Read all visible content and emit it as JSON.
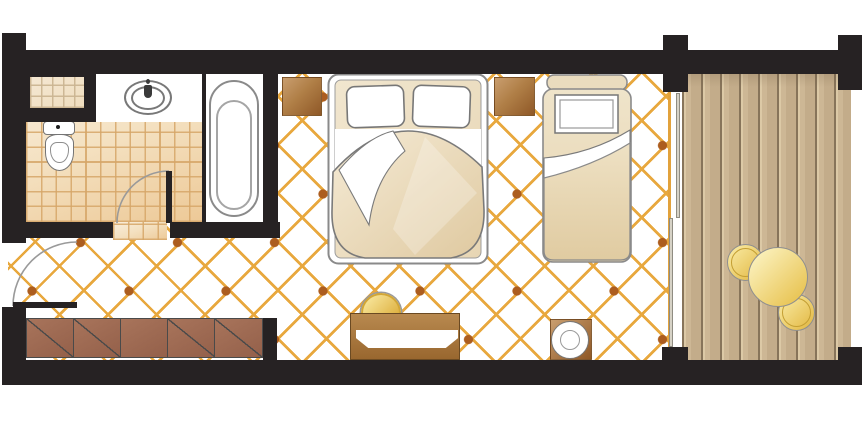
{
  "document": {
    "kind": "hotel-room-floor-plan",
    "visible_text": [],
    "orientation": "landscape"
  },
  "palette": {
    "wall": "#262223",
    "background": "#FFFFFF",
    "lattice_line": "#E8A83E",
    "lattice_diamond": "#AC5D1F",
    "bath_tile_line": "#D6A668",
    "bath_tile_fill_light": "#F9EEDC",
    "bath_tile_fill_dark": "#EDC997",
    "plank_fill": "#C8B290",
    "plank_groove": "#87745A",
    "furniture_wood_light": "#C99E6F",
    "furniture_wood_dark": "#8F5827",
    "wardrobe_panel": "#9C6852",
    "gold_furniture_light": "#FCF4C4",
    "gold_furniture_dark": "#E2B63E",
    "bed_linen_white": "#FFFFFF",
    "bed_duvet_cream": "#EFE3CA",
    "outline_gray": "#8A8A8A"
  },
  "rooms": [
    {
      "id": "bathroom",
      "furniture": [
        "washbasin-counter",
        "washbasin",
        "faucet",
        "bathtub",
        "toilet",
        "tiled-niche",
        "swing-door"
      ]
    },
    {
      "id": "bedroom",
      "furniture": [
        "double-bed",
        "pillow",
        "pillow",
        "nightstand-left",
        "nightstand-right",
        "single-bed",
        "single-bed-pillow",
        "wardrobe-5-panels",
        "desk",
        "stool",
        "side-table",
        "entry-swing-door"
      ]
    },
    {
      "id": "balcony",
      "furniture": [
        "wood-decking",
        "sliding-glass-door",
        "round-table",
        "round-chair",
        "round-chair"
      ]
    }
  ]
}
